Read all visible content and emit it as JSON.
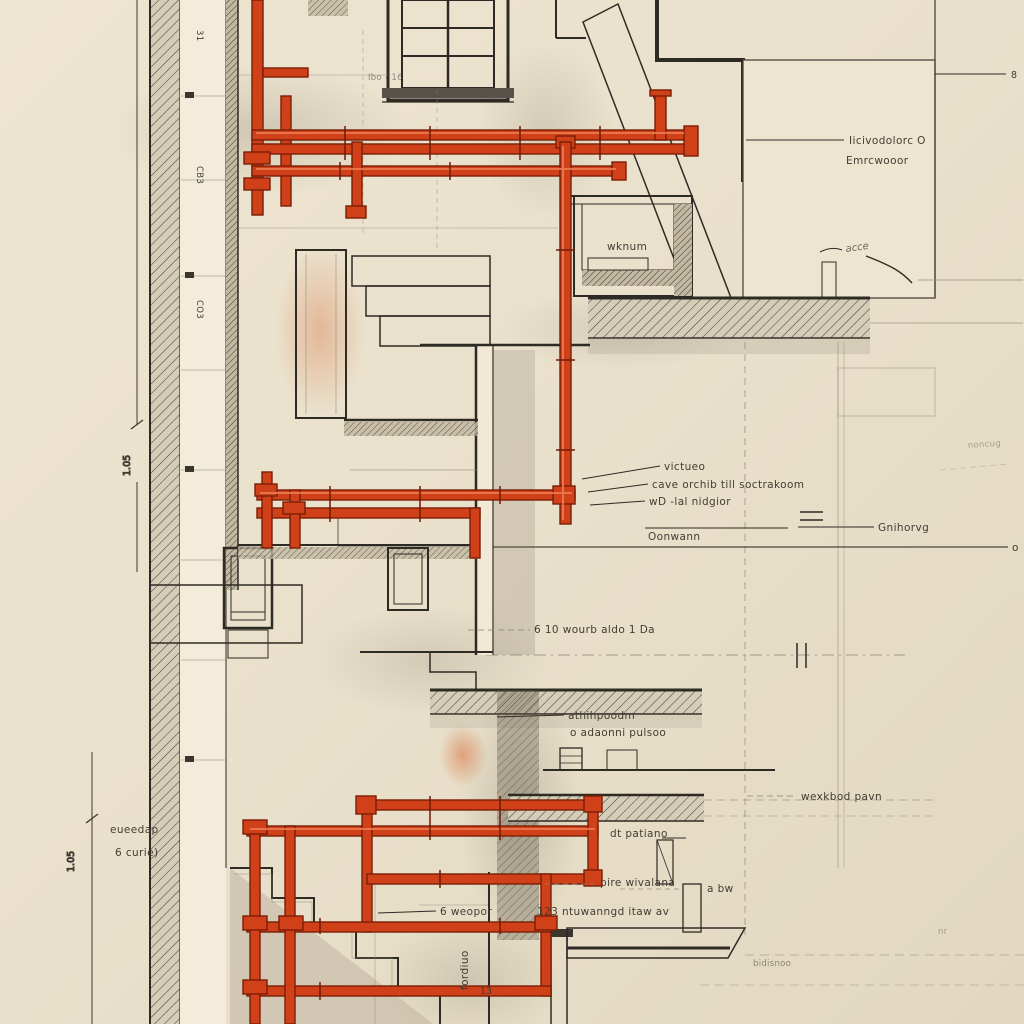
{
  "colors": {
    "paper": "#e9e0cb",
    "paper_light": "#f3ecda",
    "ink": "#2e2a24",
    "pencil": "#8f8878",
    "pipe_red": "#d04019",
    "pipe_dark": "#7a1e06",
    "pipe_highlight": "#ef8257",
    "glass_blue": "#a9bcc9",
    "wash_orange": "#d97d4e"
  },
  "dimensions": {
    "left_upper": "1.05",
    "left_lower": "1.05"
  },
  "wall_ticks": {
    "t1": "31",
    "t2": "CB3",
    "t3": "CO3"
  },
  "room": {
    "label": "wknum"
  },
  "notes": {
    "window_note": "Ibo - 16",
    "upper_right_line1": "Iicivodolorc O",
    "upper_right_line2": "Emrcwooor",
    "handwriting": "acce",
    "right_marker": "8",
    "line_end_marker": "o",
    "pipes_1": "victueo",
    "pipes_2": "cave orchib till soctrakoom",
    "pipes_3": "wD -lal nidgior",
    "datum": "Oonwann",
    "right_mid": "Gnihorvg",
    "mid_dashed": "6 10 wourb aldo    1 Da",
    "floor_1": "athihpoodm",
    "floor_2": "o adaonni pulsoo",
    "right_floor": "wexkbod pavn",
    "bottom_1": "dt patiano",
    "bottom_2": "pire wivalana",
    "bottom_3": "a bw",
    "bottom_4": "123 ntuwanngd itaw av",
    "bottom_5": "6 weopor",
    "bottom_vertical": "fordiuo",
    "left_note_1": "eueedap",
    "left_note_2": "6 curie)",
    "faint_bottom": "bidisnoo",
    "faint_bottom_right": "nr",
    "faint_right": "noncug",
    "small_number": "13"
  }
}
